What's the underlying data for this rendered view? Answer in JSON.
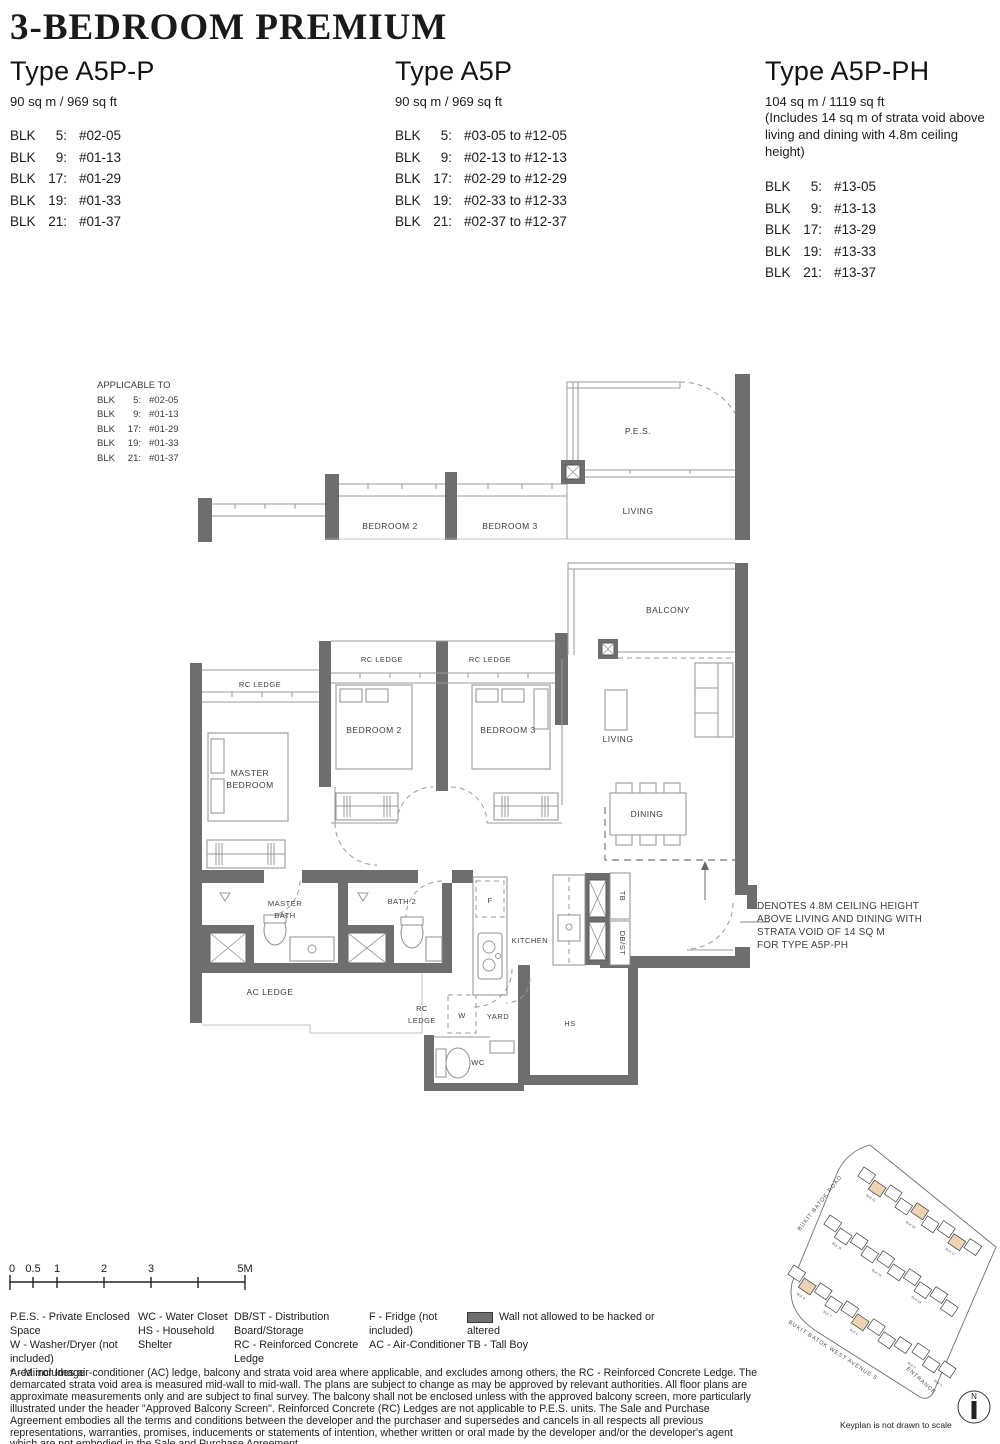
{
  "header": {
    "title": "3-BEDROOM PREMIUM"
  },
  "types": [
    {
      "name": "Type A5P-P",
      "area": "90 sq m / 969 sq ft",
      "blocks": [
        {
          "blk": "BLK",
          "no": "5:",
          "unit": "#02-05"
        },
        {
          "blk": "BLK",
          "no": "9:",
          "unit": "#01-13"
        },
        {
          "blk": "BLK",
          "no": "17:",
          "unit": "#01-29"
        },
        {
          "blk": "BLK",
          "no": "19:",
          "unit": "#01-33"
        },
        {
          "blk": "BLK",
          "no": "21:",
          "unit": "#01-37"
        }
      ]
    },
    {
      "name": "Type A5P",
      "area": "90 sq m / 969 sq ft",
      "blocks": [
        {
          "blk": "BLK",
          "no": "5:",
          "unit": "#03-05 to #12-05"
        },
        {
          "blk": "BLK",
          "no": "9:",
          "unit": "#02-13 to #12-13"
        },
        {
          "blk": "BLK",
          "no": "17:",
          "unit": "#02-29 to #12-29"
        },
        {
          "blk": "BLK",
          "no": "19:",
          "unit": "#02-33 to #12-33"
        },
        {
          "blk": "BLK",
          "no": "21:",
          "unit": "#02-37 to #12-37"
        }
      ]
    },
    {
      "name": "Type A5P-PH",
      "area": "104 sq m / 1119 sq ft",
      "notes": [
        "(Includes 14 sq m of strata void above",
        "living and dining with 4.8m ceiling height)"
      ],
      "blocks": [
        {
          "blk": "BLK",
          "no": "5:",
          "unit": "#13-05"
        },
        {
          "blk": "BLK",
          "no": "9:",
          "unit": "#13-13"
        },
        {
          "blk": "BLK",
          "no": "17:",
          "unit": "#13-29"
        },
        {
          "blk": "BLK",
          "no": "19:",
          "unit": "#13-33"
        },
        {
          "blk": "BLK",
          "no": "21:",
          "unit": "#13-37"
        }
      ]
    }
  ],
  "applicable": {
    "title": "APPLICABLE TO",
    "rows": [
      {
        "blk": "BLK",
        "no": "5:",
        "unit": "#02-05"
      },
      {
        "blk": "BLK",
        "no": "9:",
        "unit": "#01-13"
      },
      {
        "blk": "BLK",
        "no": "17:",
        "unit": "#01-29"
      },
      {
        "blk": "BLK",
        "no": "19:",
        "unit": "#01-33"
      },
      {
        "blk": "BLK",
        "no": "21:",
        "unit": "#01-37"
      }
    ]
  },
  "upper_plan": {
    "pes": "P.E.S.",
    "living": "LIVING",
    "bedroom2": "BEDROOM 2",
    "bedroom3": "BEDROOM 3"
  },
  "main_plan": {
    "balcony": "BALCONY",
    "living": "LIVING",
    "dining": "DINING",
    "master_1": "MASTER",
    "master_2": "BEDROOM",
    "bedroom2": "BEDROOM 2",
    "bedroom3": "BEDROOM 3",
    "rc_ledge_master": "RC LEDGE",
    "rc_ledge_2": "RC LEDGE",
    "rc_ledge_3": "RC LEDGE",
    "rc_b1": "RC",
    "rc_b2": "LEDGE",
    "ac_ledge": "AC LEDGE",
    "mbath_1": "MASTER",
    "mbath_2": "BATH",
    "bath2": "BATH 2",
    "kitchen": "KITCHEN",
    "f": "F",
    "w": "W",
    "wc": "WC",
    "yard": "YARD",
    "hs": "HS",
    "tb": "TB",
    "dbst": "DB/ST"
  },
  "annotation": {
    "lines": [
      "DENOTES 4.8M CEILING HEIGHT",
      "ABOVE LIVING AND DINING WITH",
      "STRATA VOID OF 14 SQ M",
      "FOR TYPE A5P-PH"
    ]
  },
  "scale_bar": {
    "labels": [
      "0",
      "0.5",
      "1",
      "2",
      "3",
      "5M"
    ]
  },
  "legend": {
    "col1": [
      "P.E.S. - Private Enclosed Space",
      "W - Washer/Dryer (not included)",
      "*   - Mirror Image"
    ],
    "col2": [
      "WC - Water Closet",
      "HS - Household Shelter"
    ],
    "col3": [
      "DB/ST - Distribution Board/Storage",
      "RC - Reinforced Concrete Ledge"
    ],
    "col4": [
      "F - Fridge (not included)",
      "AC - Air-Conditioner"
    ],
    "col5_wall": "Wall not allowed to be hacked or altered",
    "col5_tb": "TB -  Tall Boy"
  },
  "disclaimer": "Area includes air-conditioner (AC) ledge, balcony and strata void area where applicable, and excludes among others, the RC - Reinforced Concrete Ledge. The demarcated strata void area is measured mid-wall to mid-wall. The plans are subject to change as may be approved by relevant authorities. All floor plans are approximate measurements only and are subject to final survey. The balcony shall not be enclosed unless with the approved balcony screen, more particularly illustrated under the header \"Approved Balcony Screen\". Reinforced Concrete (RC) Ledges are not applicable to P.E.S. units. The Sale and Purchase Agreement embodies all the terms and conditions between the developer and the purchaser and supersedes and cancels in all respects all previous representations, warranties, promises, inducements or statements of intention, whether written or oral made by the developer and/or the developer's agent which are not embodied in the Sale and Purchase Agreement.",
  "keyplan": {
    "roads": {
      "top": "BUKIT BATOK ROAD",
      "left": "BUKIT BATOK WEST AVENUE 5",
      "entrance": "ENTRANCE"
    },
    "caption": "Keyplan is not drawn to scale",
    "compass": "N",
    "row_angle": 34,
    "rows": [
      {
        "tx": 86,
        "ty": 32,
        "n": 9,
        "hl": [
          1,
          4,
          7
        ],
        "labels": [
          [
            1,
            "BLK 21"
          ],
          [
            4,
            "BLK 19"
          ],
          [
            7,
            "BLK 17"
          ]
        ]
      },
      {
        "tx": 52,
        "ty": 80,
        "n": 10,
        "hl": [],
        "labels": [
          [
            1,
            "BLK 11"
          ],
          [
            4,
            "BLK 13"
          ],
          [
            7,
            "BLK 15"
          ]
        ]
      },
      {
        "tx": 16,
        "ty": 130,
        "n": 9,
        "hl": [
          1,
          5
        ],
        "labels": [
          [
            1,
            "BLK 9"
          ],
          [
            3,
            "BLK 7"
          ],
          [
            5,
            "BLK 5"
          ]
        ]
      },
      {
        "tx": 140,
        "ty": 208,
        "n": 3,
        "hl": [],
        "labels": [
          [
            0,
            "BLK 3"
          ],
          [
            2,
            "BLK 1"
          ]
        ]
      }
    ],
    "colors": {
      "highlight": "#ecd3b4"
    }
  },
  "colors": {
    "wall": "#6e6e6e",
    "line": "#9a9a9a"
  }
}
